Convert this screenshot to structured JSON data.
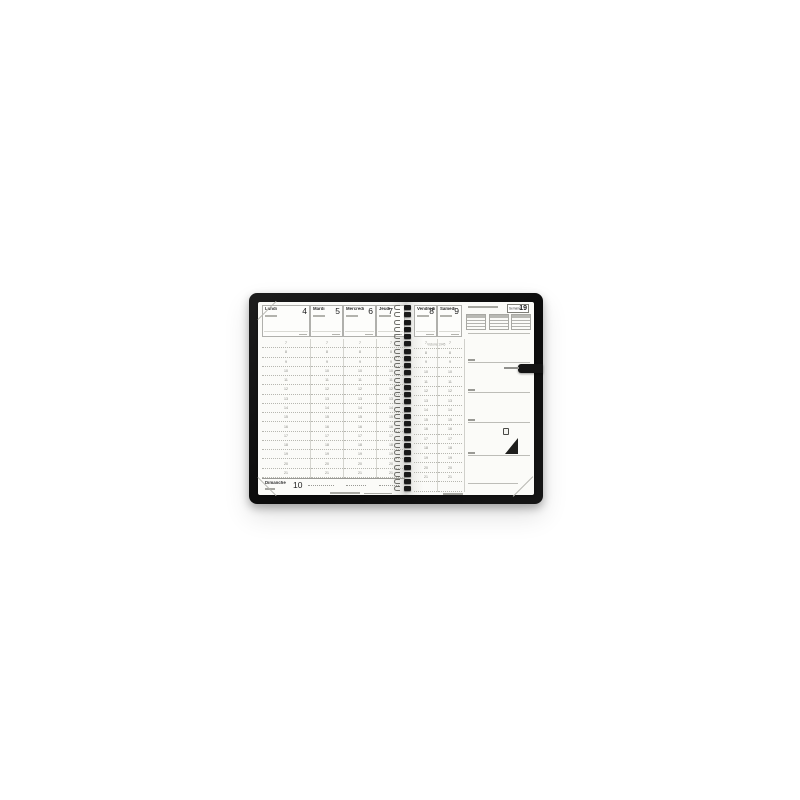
{
  "scene": {
    "type": "product-photo",
    "subject": "Open spiral-bound weekly planner with black cover",
    "background_color": "#ffffff",
    "cover_color": "#111111",
    "page_color": "#fbfbf8"
  },
  "week_badge": {
    "label": "Semaine",
    "number": "19"
  },
  "left_page": {
    "days": [
      {
        "name": "Lundi",
        "date": "4"
      },
      {
        "name": "Mardi",
        "date": "5"
      },
      {
        "name": "Mercredi",
        "date": "6"
      },
      {
        "name": "Jeudi",
        "date": "7"
      }
    ],
    "sunday": {
      "name": "Dimanche",
      "date": "10"
    }
  },
  "right_page": {
    "days": [
      {
        "name": "Vendredi",
        "date": "8"
      },
      {
        "name": "Samedi",
        "date": "9"
      }
    ],
    "holiday_note": "Victoire 1945"
  },
  "hours": [
    "7",
    "8",
    "9",
    "10",
    "11",
    "12",
    "13",
    "14",
    "15",
    "16",
    "17",
    "18",
    "19",
    "20",
    "21"
  ],
  "icons": {
    "logo": "sailboat-icon",
    "bookmark": "bookmark-tab"
  }
}
